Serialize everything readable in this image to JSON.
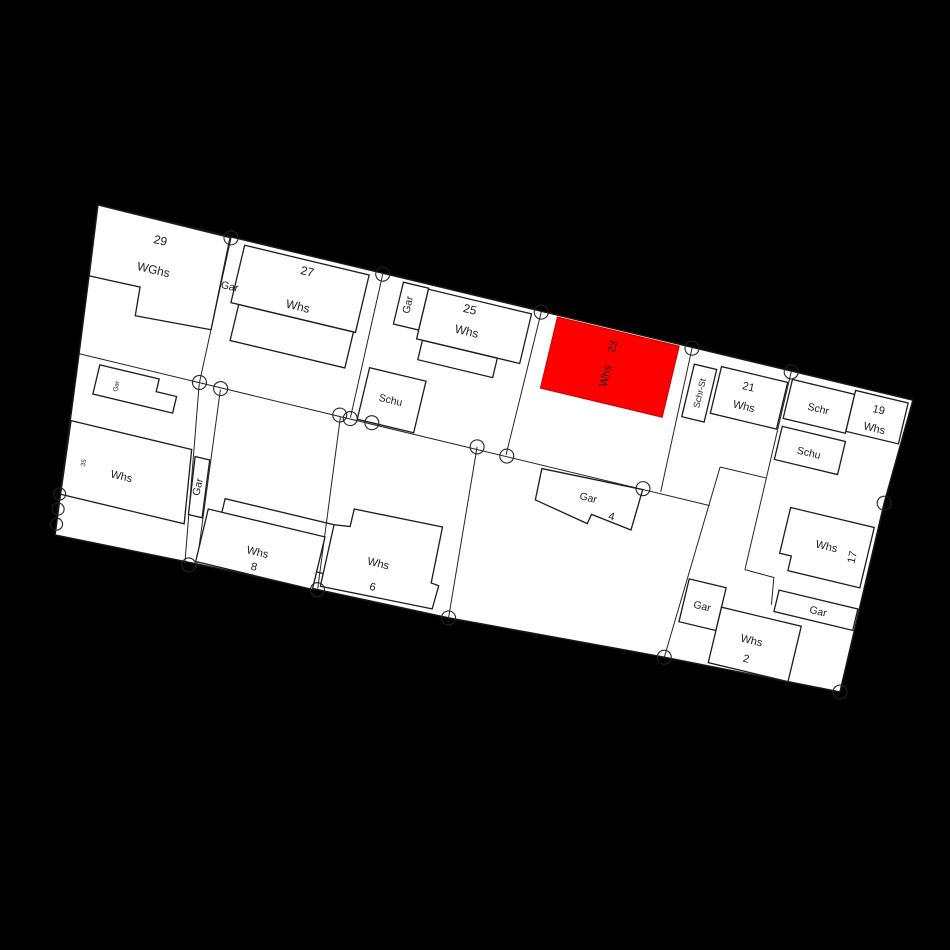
{
  "map": {
    "type": "cadastral-parcel-map",
    "colors": {
      "background": "#000000",
      "parcel_fill": "#ffffff",
      "line": "#1c1c1c",
      "highlight": "#ff0000"
    },
    "labels": {
      "whs29_no": "29",
      "whs29_type": "WGhs",
      "gar29": "Gar",
      "whs27_no": "27",
      "whs27_type": "Whs",
      "gar25": "Gar",
      "whs25_no": "25",
      "whs25_type": "Whs",
      "schu25": "Schu",
      "whs23_no": "23",
      "whs23_type": "Whs",
      "schrst21": "Schr-St",
      "whs21_no": "21",
      "whs21_type": "Whs",
      "schr19": "Schr",
      "whs19_no": "19",
      "whs19_type": "Whs",
      "schu19": "Schu",
      "gar4": "Gar",
      "gar4_no": "4",
      "whs8_type": "Whs",
      "whs8_no": "8",
      "whs6_type": "Whs",
      "whs6_no": "6",
      "whs35_type": "Whs",
      "whs35_no": "35",
      "gar_strip": "Gar",
      "gar_small": "Gar",
      "gar2_left": "Gar",
      "whs2_type": "Whs",
      "whs2_no": "2",
      "gar17": "Gar",
      "whs17_type": "Whs",
      "whs17_no": "17"
    }
  }
}
